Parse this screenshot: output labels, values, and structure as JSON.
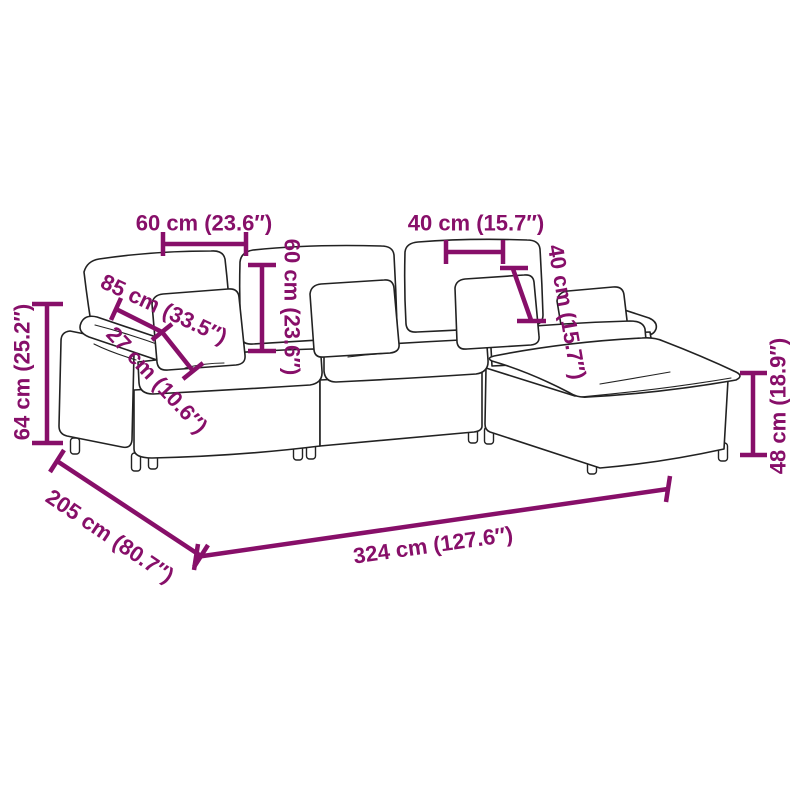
{
  "page": {
    "background": "#ffffff",
    "accent_color": "#870F69",
    "outline_color": "#222222",
    "product": "modular-l-shaped-sofa-with-ottoman-dimension-diagram"
  },
  "dims": {
    "back_cushion_width": {
      "label": "60 cm (23.6″)"
    },
    "backrest_height": {
      "label": "60 cm (23.6″)"
    },
    "pillow_width": {
      "label": "40 cm (15.7″)"
    },
    "pillow_height": {
      "label": "40 cm (15.7″)"
    },
    "seat_depth": {
      "label": "85 cm (33.5″)"
    },
    "armrest_width": {
      "label": "27 cm (10.6″)"
    },
    "overall_height": {
      "label": "64 cm (25.2″)"
    },
    "ottoman_height": {
      "label": "48 cm (18.9″)"
    },
    "overall_depth": {
      "label": "205 cm (80.7″)"
    },
    "overall_width": {
      "label": "324 cm (127.6″)"
    }
  }
}
